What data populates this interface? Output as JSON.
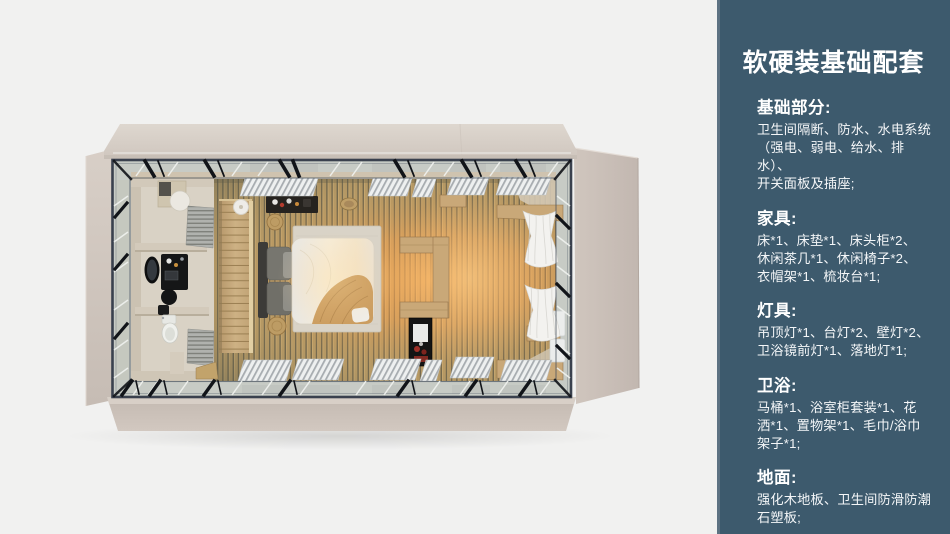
{
  "colors": {
    "canvas_bg": "#f1f1f0",
    "panel_bg": "#3d5a6d",
    "panel_edge": "#5d7282",
    "panel_text": "#ffffff",
    "wall_beige": "#d5ccc4",
    "floor_wood": "#bc9d66",
    "floor_glow": "#f0a452",
    "frame_dark": "#3a414e"
  },
  "panel": {
    "title": "软硬装基础配套",
    "sections": [
      {
        "title": "基础部分:",
        "body": "卫生间隔断、防水、水电系统\n（强电、弱电、给水、排水）、\n开关面板及插座;"
      },
      {
        "title": "家具:",
        "body": "床*1、床垫*1、床头柜*2、\n休闲茶几*1、休闲椅子*2、\n衣帽架*1、梳妆台*1;"
      },
      {
        "title": "灯具:",
        "body": "吊顶灯*1、台灯*2、壁灯*2、\n卫浴镜前灯*1、落地灯*1;"
      },
      {
        "title": "卫浴:",
        "body": "马桶*1、浴室柜套装*1、花\n洒*1、置物架*1、毛巾/浴巾\n架子*1;"
      },
      {
        "title": "地面:",
        "body": "强化木地板、卫生间防滑防潮\n石塑板;"
      }
    ]
  }
}
